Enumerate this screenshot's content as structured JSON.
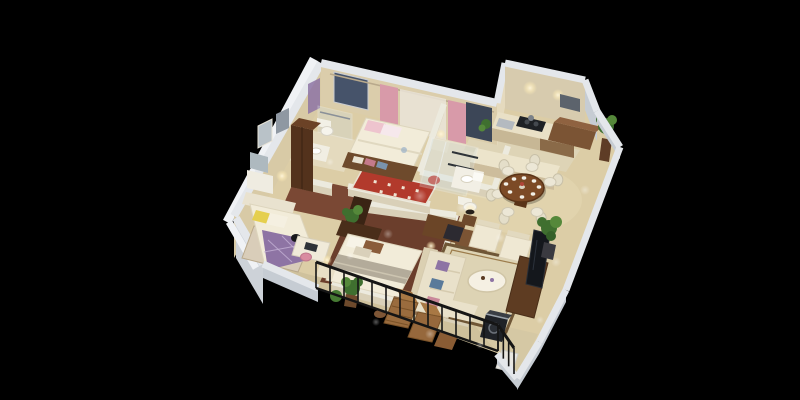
{
  "scene": {
    "title": "3D isometric cutaway floor plan of a three-bedroom apartment rendered on a black background",
    "style": "isometric-cutaway-render",
    "background": "#000000",
    "rooms": [
      {
        "id": "bedroom-pink",
        "label": "Bedroom with pink curtains",
        "furniture": [
          "double bed",
          "pink pillows",
          "storage bench with clothes",
          "red patterned rug",
          "nightstand with lamp",
          "wardrobe"
        ]
      },
      {
        "id": "ensuite-bathroom",
        "label": "En-suite bathroom",
        "furniture": [
          "toilet",
          "vanity basin",
          "glass shower"
        ]
      },
      {
        "id": "bedroom-purple",
        "label": "Bedroom with purple bedding",
        "furniture": [
          "double bed",
          "yellow pillow",
          "desk",
          "pink chair",
          "nightstand with lamp",
          "dresser with mirror",
          "potted plant"
        ]
      },
      {
        "id": "master-bedroom",
        "label": "Master bedroom",
        "furniture": [
          "double bed with striped duvet",
          "dark headboard",
          "two nightstands with lamps",
          "wardrobe units",
          "foot bench"
        ]
      },
      {
        "id": "shower-room",
        "label": "Shower room",
        "furniture": [
          "glass shower",
          "vanity basin",
          "toilet",
          "towel bars"
        ]
      },
      {
        "id": "kitchen",
        "label": "Kitchen",
        "furniture": [
          "counter with sink",
          "black cooktop",
          "peninsula counter",
          "base cabinets",
          "small plant"
        ]
      },
      {
        "id": "dining-room",
        "label": "Dining room",
        "furniture": [
          "round wooden table",
          "six white chairs",
          "place settings",
          "sideboard",
          "potted plants"
        ]
      },
      {
        "id": "living-room",
        "label": "Living room",
        "furniture": [
          "cream sofa",
          "two armchairs",
          "dark reading chair",
          "oval coffee table",
          "bordered area rug",
          "TV console",
          "TV panel",
          "tall potted plant",
          "lamp"
        ]
      },
      {
        "id": "balcony",
        "label": "Balcony",
        "furniture": [
          "black iron railing",
          "wooden lounge chairs",
          "footstool",
          "small table",
          "potted plants"
        ]
      },
      {
        "id": "utility-room",
        "label": "Utility room",
        "furniture": [
          "washing machine",
          "white cabinet"
        ]
      }
    ],
    "palette": {
      "background": "#000000",
      "wallTop": "#e4e7eb",
      "wallTopBright": "#f0f2f5",
      "wallSideGrey": "#c6ccd3",
      "wallFaceCream": "#d9cba9",
      "wallFaceCreamLight": "#e6dcc0",
      "floorCream": "#dccda6",
      "floorTileLight": "#e4dabe",
      "floorWood": "#7a4834",
      "floorWoodDark": "#6b3e2c",
      "balconyStone": "#cfc19c",
      "bedWhite": "#f2ecd9",
      "purple": "#8e74a4",
      "purpleLight": "#c4b2d4",
      "pinkCurtain": "#d89aa9",
      "pinkPillow": "#eec4ce",
      "redRug": "#b23a2c",
      "yellow": "#e5cf4e",
      "sofaCream": "#e9e1ca",
      "creamChair": "#efe8d3",
      "woodDark": "#53321c",
      "woodMid": "#6e4a2c",
      "woodWarm": "#8a6a48",
      "tableWood": "#7c4a26",
      "plantGreen": "#3f6f2f",
      "plantLight": "#55883a",
      "railBlack": "#151515",
      "tvDark": "#14171c",
      "glass": "#cfe0e6",
      "steel": "#b4bac0",
      "glowWarm": "#ffe9b8",
      "windowBlue": "#46536a"
    }
  }
}
